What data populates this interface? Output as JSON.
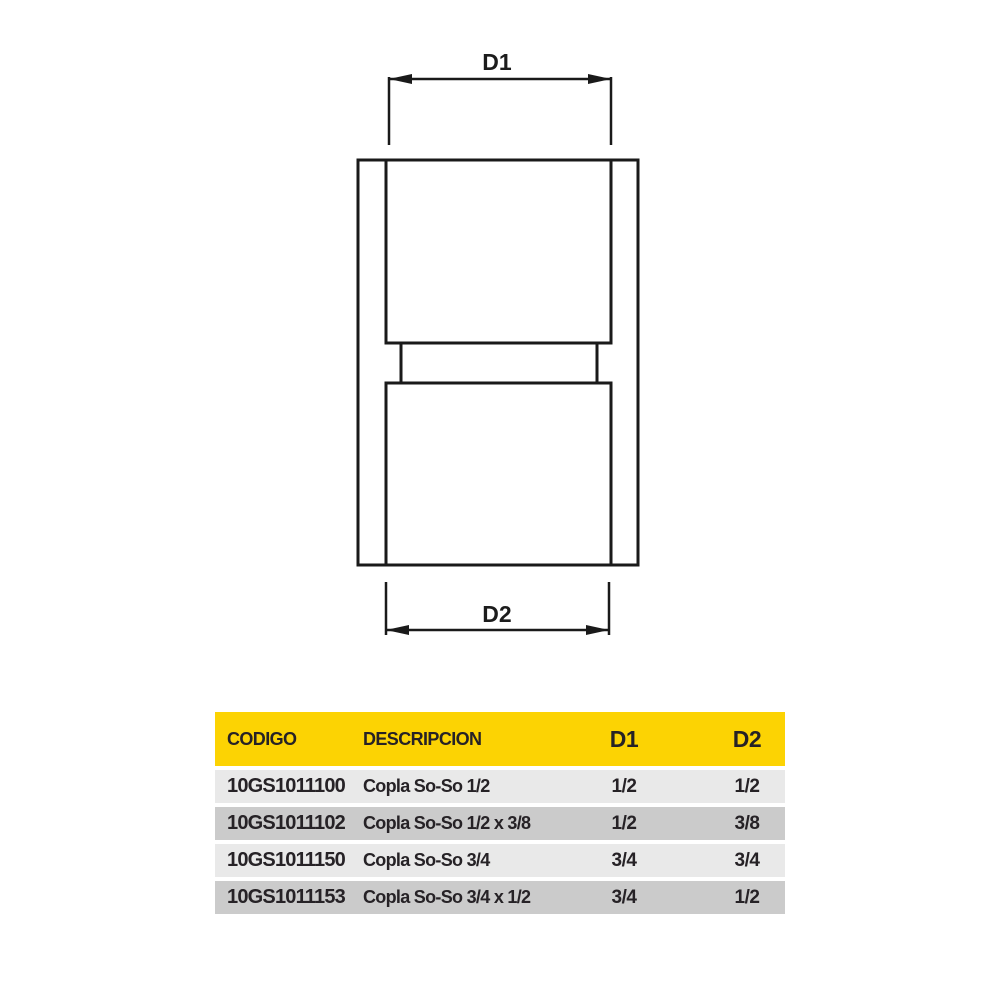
{
  "diagram": {
    "name": "pipe-coupling-technical-drawing",
    "labels": {
      "d1": "D1",
      "d2": "D2"
    },
    "line_color": "#1a1a1a"
  },
  "table": {
    "colors": {
      "header_bg": "#fcd303",
      "row_light": "#e9e9e9",
      "row_dark": "#cbcbcb",
      "text": "#262226"
    },
    "headers": [
      "CODIGO",
      "DESCRIPCION",
      "D1",
      "D2"
    ],
    "rows": [
      {
        "codigo": "10GS1011100",
        "descripcion": "Copla So-So 1/2",
        "d1": "1/2",
        "d2": "1/2"
      },
      {
        "codigo": "10GS1011102",
        "descripcion": "Copla So-So 1/2 x 3/8",
        "d1": "1/2",
        "d2": "3/8"
      },
      {
        "codigo": "10GS1011150",
        "descripcion": "Copla So-So 3/4",
        "d1": "3/4",
        "d2": "3/4"
      },
      {
        "codigo": "10GS1011153",
        "descripcion": "Copla So-So 3/4 x 1/2",
        "d1": "3/4",
        "d2": "1/2"
      }
    ]
  }
}
